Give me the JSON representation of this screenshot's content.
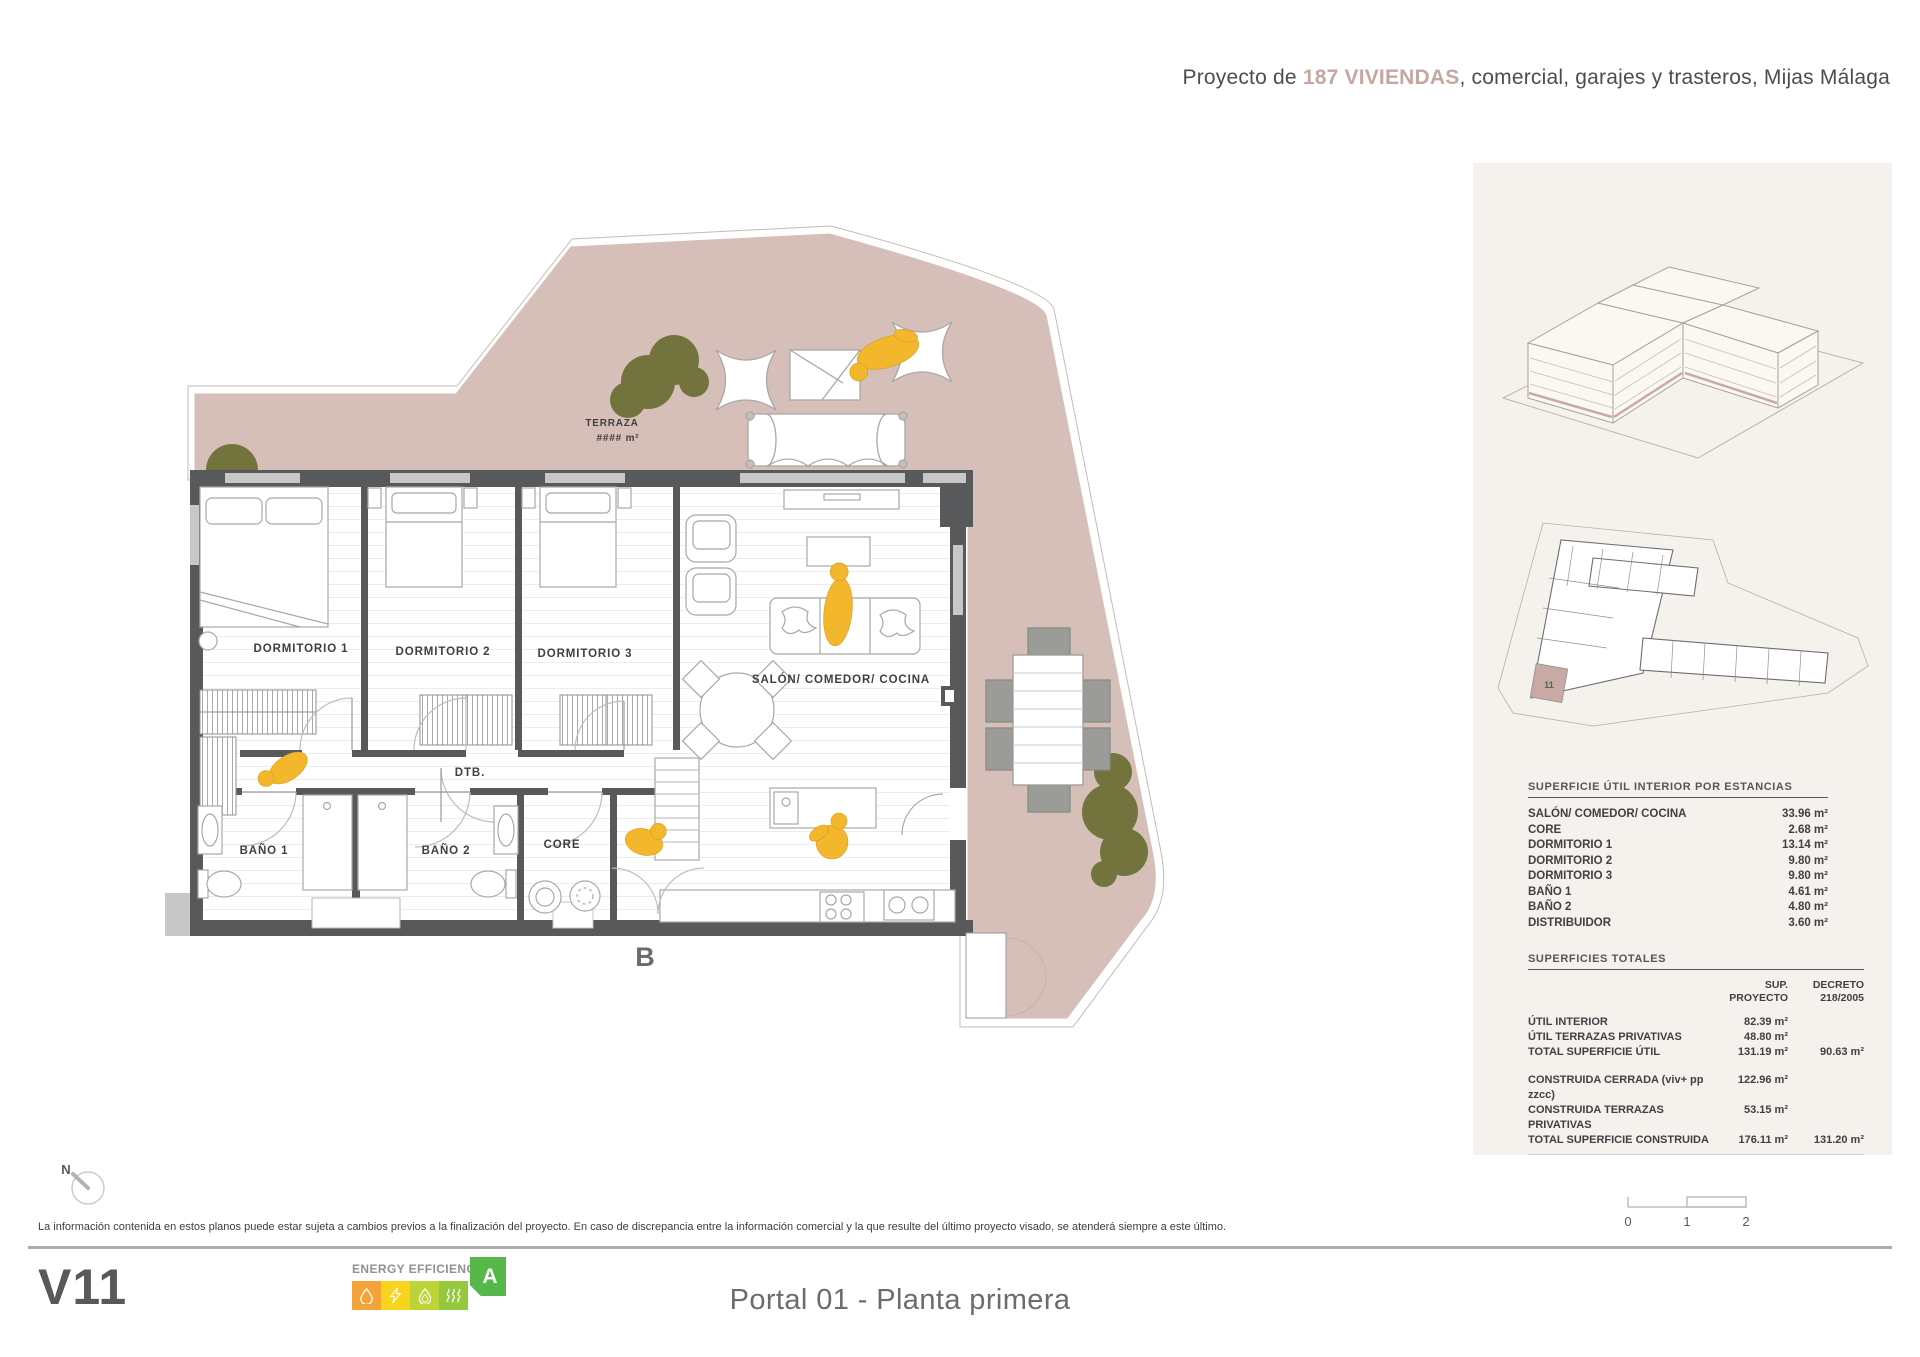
{
  "header": {
    "prefix": "Proyecto de ",
    "highlight": "187 VIVIENDAS",
    "suffix": ", comercial, garajes y trasteros, Mijas Málaga"
  },
  "plan": {
    "terraza": "TERRAZA",
    "terraza_area": "#### m²",
    "dorm1": "DORMITORIO 1",
    "dorm2": "DORMITORIO 2",
    "dorm3": "DORMITORIO 3",
    "salon": "SALÓN/ COMEDOR/ COCINA",
    "dtb": "DTB.",
    "bano1": "BAÑO 1",
    "bano2": "BAÑO 2",
    "core": "CORE",
    "block": "B",
    "north": "N"
  },
  "sidebar": {
    "keyplan_unit": "11",
    "table1": {
      "title": "SUPERFICIE ÚTIL INTERIOR POR ESTANCIAS",
      "rows": [
        {
          "label": "SALÓN/ COMEDOR/ COCINA",
          "value": "33.96 m²"
        },
        {
          "label": "CORE",
          "value": "2.68 m²"
        },
        {
          "label": "DORMITORIO 1",
          "value": "13.14 m²"
        },
        {
          "label": "DORMITORIO 2",
          "value": "9.80 m²"
        },
        {
          "label": "DORMITORIO 3",
          "value": "9.80 m²"
        },
        {
          "label": "BAÑO 1",
          "value": "4.61 m²"
        },
        {
          "label": "BAÑO 2",
          "value": "4.80 m²"
        },
        {
          "label": "DISTRIBUIDOR",
          "value": "3.60 m²"
        }
      ]
    },
    "table2": {
      "title": "SUPERFICIES TOTALES",
      "col1_line1": "SUP.",
      "col1_line2": "PROYECTO",
      "col2_line1": "DECRETO",
      "col2_line2": "218/2005",
      "rows_util": [
        {
          "label": "ÚTIL INTERIOR",
          "v1": "82.39 m²",
          "v2": ""
        },
        {
          "label": "ÚTIL TERRAZAS PRIVATIVAS",
          "v1": "48.80 m²",
          "v2": ""
        },
        {
          "label": "TOTAL SUPERFICIE ÚTIL",
          "v1": "131.19 m²",
          "v2": "90.63 m²"
        }
      ],
      "rows_built": [
        {
          "label": "CONSTRUIDA CERRADA (viv+ pp zzcc)",
          "v1": "122.96 m²",
          "v2": ""
        },
        {
          "label": "CONSTRUIDA TERRAZAS PRIVATIVAS",
          "v1": "53.15 m²",
          "v2": ""
        },
        {
          "label": "TOTAL SUPERFICIE CONSTRUIDA",
          "v1": "176.11 m²",
          "v2": "131.20 m²"
        }
      ]
    }
  },
  "scalebar": {
    "t0": "0",
    "t1": "1",
    "t2": "2"
  },
  "disclaimer": "La información contenida en estos planos puede estar sujeta a cambios previos a la finalización del proyecto. En caso de discrepancia entre la información comercial y la que resulte del último proyecto visado, se atenderá siempre a este último.",
  "footer": {
    "version": "V11",
    "energy_title": "ENERGY EFFICIENCY",
    "energy_class": "A",
    "plan_title": "Portal 01 - Planta primera"
  },
  "colors": {
    "terrace_pink": "#d5bfb8",
    "wall_dark": "#58595b",
    "accent_pink_text": "#c5a6a0",
    "olive_tree": "#6f7039",
    "figure_yellow": "#f2b72c",
    "sidebar_bg": "#f5f1ec",
    "energy_orange": "#f2a33a",
    "energy_yellow": "#f8d41c",
    "energy_lime": "#bcd435",
    "energy_green": "#94c93d",
    "energy_class_green": "#55b848"
  }
}
